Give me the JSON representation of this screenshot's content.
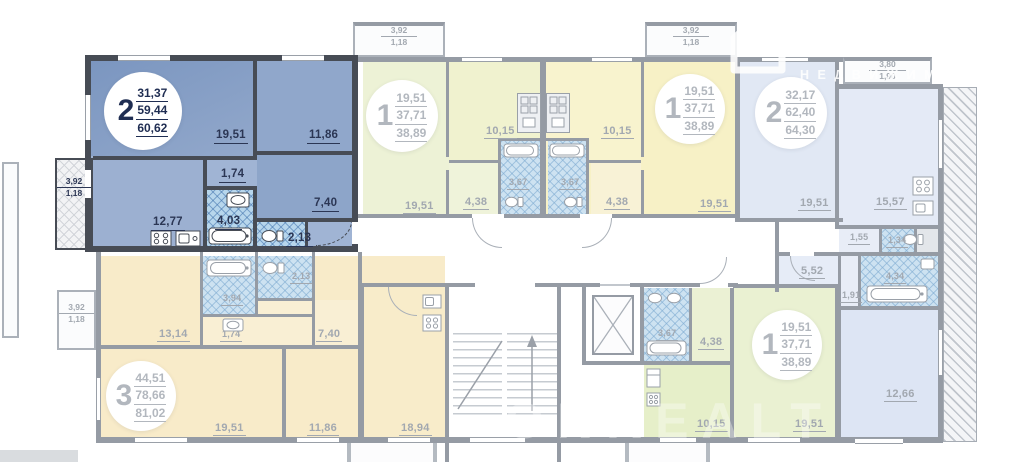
{
  "watermark": {
    "brand": "ONREALT",
    "subtitle": "НЕДВИЖИМОСТЬ",
    "brand_ghost": "ONREALT"
  },
  "colors": {
    "highlight_fill": "#8aa4c9",
    "highlight_wall": "#474c55",
    "highlight_label": "#2b3654",
    "wall": "#959ba4",
    "label": "#a2a8b0",
    "green_fill": "#edf2d6",
    "yellow_fill": "#f7f1c6",
    "lavender_fill": "#e1e8f4",
    "cream_fill": "#f8ebc9"
  },
  "apartments": {
    "a1": {
      "type": "2",
      "area_living": "31,37",
      "area_usable": "59,44",
      "area_total": "60,62",
      "rooms": {
        "living": "19,51",
        "bedroom": "11,86",
        "hall": "1,74",
        "cabinet": "7,40",
        "kitchen": "12,77",
        "bath": "4,03",
        "wc": "2,13"
      },
      "balcony": {
        "full": "3,92",
        "half": "1,18"
      }
    },
    "a2": {
      "type": "1",
      "area_living": "19,51",
      "area_usable": "37,71",
      "area_total": "38,89",
      "rooms": {
        "living": "19,51",
        "kitchen": "10,15",
        "hall": "4,38",
        "bath": "3,67"
      },
      "balcony": {
        "full": "3,92",
        "half": "1,18"
      }
    },
    "a3": {
      "type": "1",
      "area_living": "19,51",
      "area_usable": "37,71",
      "area_total": "38,89",
      "rooms": {
        "living": "19,51",
        "kitchen": "10,15",
        "hall": "4,38",
        "bath": "3,67"
      },
      "balcony": {
        "full": "3,92",
        "half": "1,18"
      }
    },
    "a4": {
      "type": "2",
      "area_living": "32,17",
      "area_usable": "62,40",
      "area_total": "64,30",
      "rooms": {
        "living": "19,51",
        "kitchen": "15,57",
        "hall1": "1,55",
        "wc": "1,34",
        "hall2": "5,52",
        "corridor": "1,91",
        "bath": "4,34",
        "bedroom": "12,66"
      },
      "balcony": {
        "full": "3,80",
        "half": "1,90"
      }
    },
    "a5": {
      "type": "3",
      "area_living": "44,51",
      "area_usable": "78,66",
      "area_total": "81,02",
      "rooms": {
        "bedroom1": "13,14",
        "hall": "1,74",
        "cabinet": "7,40",
        "bath": "3,94",
        "wc": "2,13",
        "living": "19,51",
        "bedroom2": "11,86",
        "kitchen": "18,94"
      },
      "balcony": {
        "full": "3,92",
        "half": "1,18"
      }
    },
    "a6": {
      "type": "1",
      "area_living": "19,51",
      "area_usable": "37,71",
      "area_total": "38,89",
      "rooms": {
        "bath": "3,67",
        "hall": "4,38",
        "kitchen": "10,15",
        "living": "19,51"
      }
    }
  }
}
